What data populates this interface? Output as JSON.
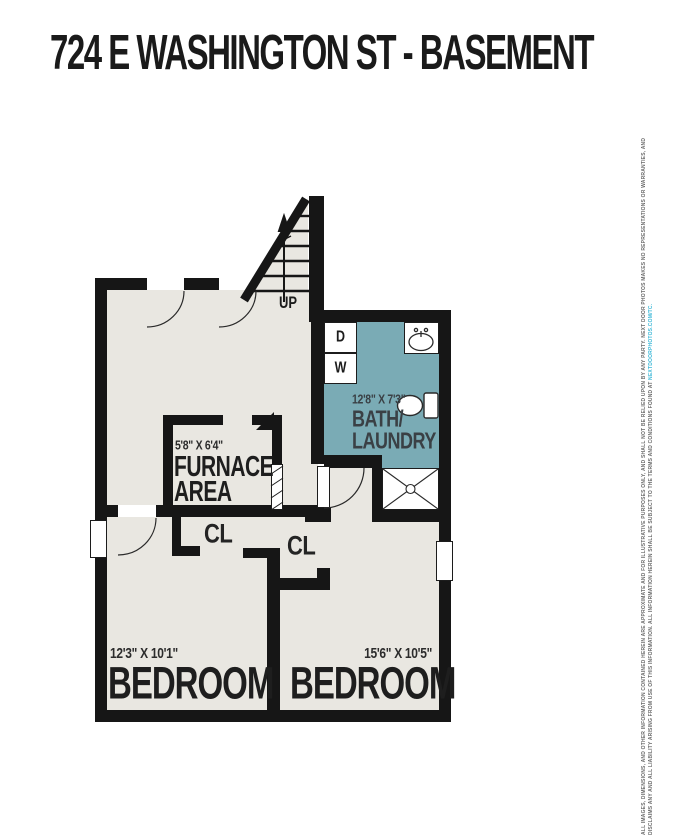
{
  "title": "724 E WASHINGTON ST - BASEMENT",
  "plan": {
    "stairs": {
      "label": "UP"
    },
    "laundry": {
      "dryer": "D",
      "washer": "W"
    },
    "bath": {
      "dims": "12'8\" X 7'3\"",
      "name_line1": "BATH/",
      "name_line2": "LAUNDRY"
    },
    "furnace": {
      "dims": "5'8\" X 6'4\"",
      "name_line1": "FURNACE",
      "name_line2": "AREA"
    },
    "closet1": {
      "label": "CL"
    },
    "closet2": {
      "label": "CL"
    },
    "bedroom1": {
      "dims": "12'3\" X 10'1\"",
      "name": "BEDROOM"
    },
    "bedroom2": {
      "dims": "15'6\" X 10'5\"",
      "name": "BEDROOM"
    }
  },
  "disclaimer": {
    "text": "ALL IMAGES, DIMENSIONS, AND OTHER INFORMATION CONTAINED HEREIN ARE APPROXIMATE AND FOR ILLUSTRATIVE PURPOSES ONLY, AND SHALL NOT BE RELIED UPON BY ANY PARTY. NEXT DOOR PHOTOS MAKES NO REPRESENTATIONS OR WARRANTIES, AND DISCLAIMS ANY AND ALL LIABILITY ARISING FROM USE OF THIS INFORMATION. ALL INFORMATION HEREIN SHALL BE SUBJECT TO THE TERMS AND CONDITIONS FOUND AT ",
    "link": "NEXTDOORPHOTOS.COM/TC."
  },
  "colors": {
    "wall": "#161616",
    "floor": "#e9e7e1",
    "bath_floor": "#7aabb5",
    "link_blue": "#3fb9d8",
    "label_dark": "#1e1e1e"
  }
}
